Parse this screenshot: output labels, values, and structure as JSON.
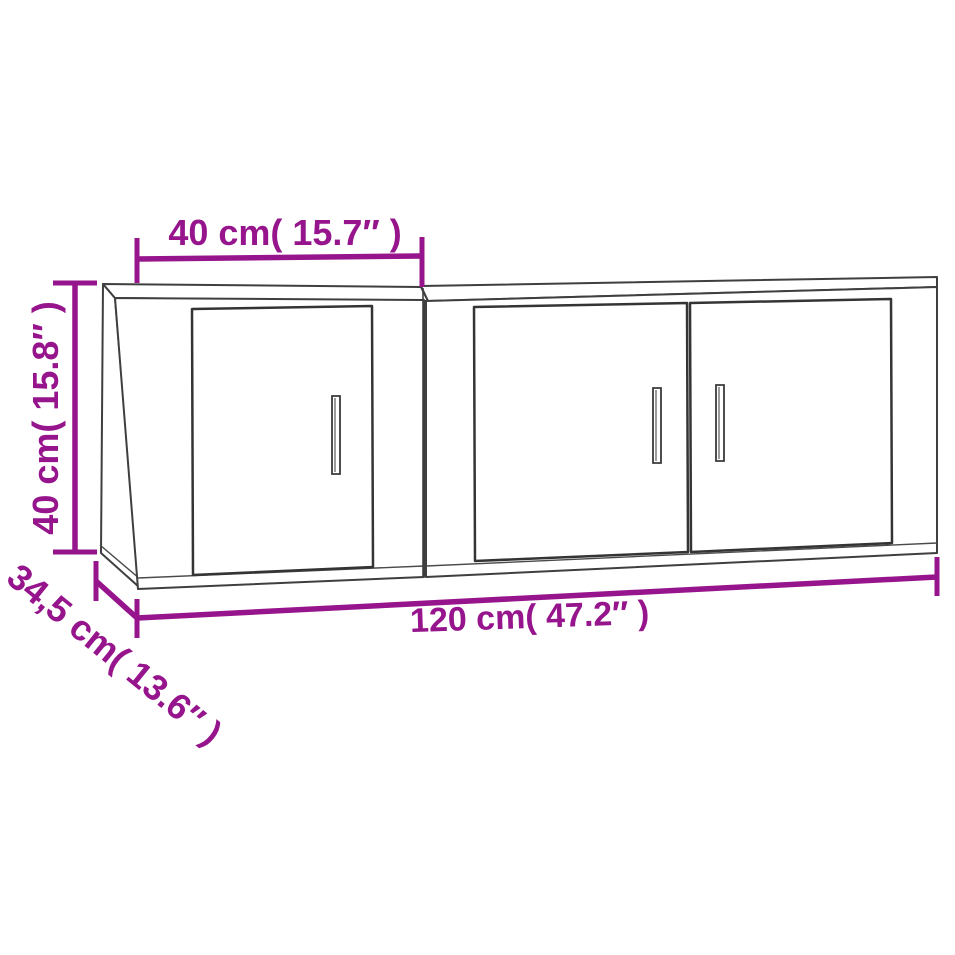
{
  "diagram": {
    "name": "wall-tv-cabinet-set-dimension-diagram",
    "background": "#ffffff",
    "outline_color": "#3f3f3f",
    "dimension_color": "#96148c",
    "dimensions": {
      "cabinet_width_top": "40 cm( 15.7″ )",
      "cabinet_height_left": "40 cm( 15.8″ )",
      "cabinet_depth_diagonal": "34,5 cm( 13.6″ )",
      "total_width_bottom": "120 cm( 47.2″ )"
    },
    "values": {
      "cabinet_width_cm": "40",
      "cabinet_height_cm": "40",
      "cabinet_depth_cm": "34,5",
      "total_width_cm": "120"
    }
  }
}
